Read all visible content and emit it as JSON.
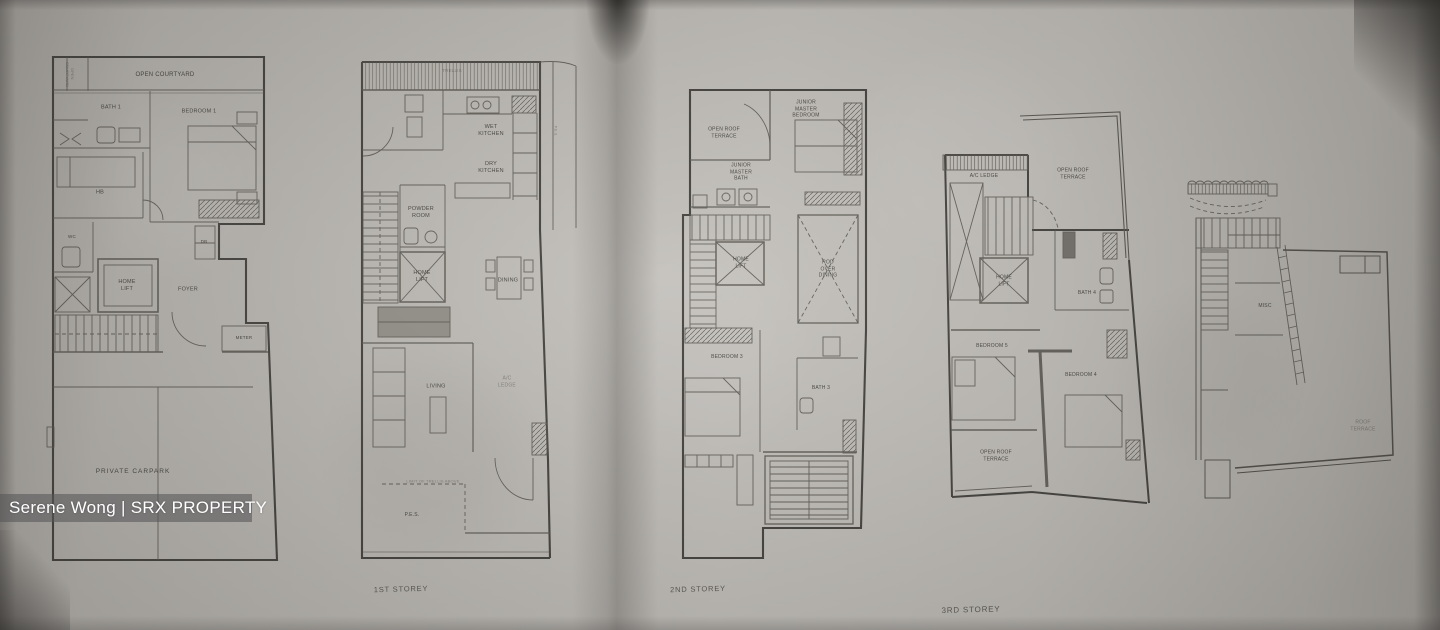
{
  "watermark": {
    "text": "Serene Wong | SRX PROPERTY"
  },
  "colors": {
    "paper": "#c4c1bc",
    "ink": "#504d48",
    "watermark_bar": "rgba(86,86,88,0.58)",
    "watermark_text": "#ffffff"
  },
  "plan_carpark_level": {
    "open_courtyard": "OPEN COURTYARD",
    "open_courtyard_side": "OPEN COURTYARD",
    "bath1": "BATH 1",
    "bedroom1": "BEDROOM 1",
    "hb": "HB",
    "wc": "WC",
    "db": "DB",
    "home_lift": "HOME LIFT",
    "foyer": "FOYER",
    "meter": "METER",
    "carpark": "PRIVATE CARPARK"
  },
  "plan_1st_storey": {
    "trellis": "TRELLIS",
    "wet_kitchen": "WET KITCHEN",
    "dry_kitchen": "DRY KITCHEN",
    "pes_side": "P.E.S.",
    "powder_room": "POWDER ROOM",
    "home_lift": "HOME LIFT",
    "dining": "DINING",
    "living": "LIVING",
    "ac_ledge": "A/C LEDGE",
    "limit_note": "LIMIT OF TRELLIS ABOVE",
    "pes": "P.E.S.",
    "storey": "1ST STOREY"
  },
  "plan_2nd_storey": {
    "open_roof_terrace": "OPEN ROOF TERRACE",
    "junior_master_bedroom": "JUNIOR MASTER BEDROOM",
    "junior_master_bath": "JUNIOR MASTER BATH",
    "home_lift": "HOME LIFT",
    "rod_over_dining": "ROD OVER DINING",
    "bedroom3": "BEDROOM 3",
    "bath3": "BATH 3",
    "storey": "2ND STOREY"
  },
  "plan_3rd_storey": {
    "ac_ledge": "A/C LEDGE",
    "open_roof_terrace_top": "OPEN ROOF TERRACE",
    "home_lift": "HOME LIFT",
    "bath4": "BATH 4",
    "bedroom5": "BEDROOM 5",
    "bedroom4": "BEDROOM 4",
    "open_roof_terrace_bottom": "OPEN ROOF TERRACE",
    "storey": "3RD STOREY"
  },
  "plan_attic": {
    "misc": "MISC",
    "roof_terrace": "ROOF TERRACE"
  }
}
